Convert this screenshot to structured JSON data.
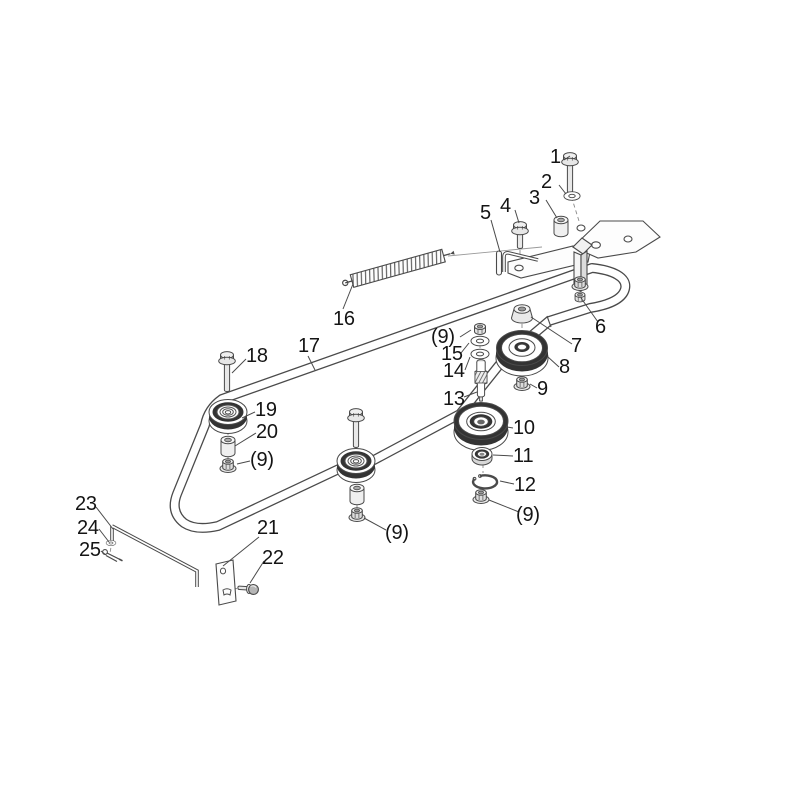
{
  "diagram": {
    "kind": "exploded-parts-diagram",
    "colors": {
      "background": "#ffffff",
      "line": "#4a4a4a",
      "dark_fill": "#333333",
      "label_text": "#141414"
    },
    "callouts": [
      {
        "id": "c1",
        "label": "1"
      },
      {
        "id": "c2",
        "label": "2"
      },
      {
        "id": "c3",
        "label": "3"
      },
      {
        "id": "c4",
        "label": "4"
      },
      {
        "id": "c5",
        "label": "5"
      },
      {
        "id": "c6",
        "label": "6"
      },
      {
        "id": "c7",
        "label": "7"
      },
      {
        "id": "c8",
        "label": "8"
      },
      {
        "id": "c9",
        "label": "9"
      },
      {
        "id": "c10",
        "label": "10"
      },
      {
        "id": "c11",
        "label": "11"
      },
      {
        "id": "c12",
        "label": "12"
      },
      {
        "id": "c13",
        "label": "13"
      },
      {
        "id": "c14",
        "label": "14"
      },
      {
        "id": "c15",
        "label": "15"
      },
      {
        "id": "c16",
        "label": "16"
      },
      {
        "id": "c17",
        "label": "17"
      },
      {
        "id": "c18",
        "label": "18"
      },
      {
        "id": "c19",
        "label": "19"
      },
      {
        "id": "c20",
        "label": "20"
      },
      {
        "id": "c21",
        "label": "21"
      },
      {
        "id": "c22",
        "label": "22"
      },
      {
        "id": "c23",
        "label": "23"
      },
      {
        "id": "c24",
        "label": "24"
      },
      {
        "id": "c25",
        "label": "25"
      },
      {
        "id": "c9qty-right-top",
        "label": "(9)"
      },
      {
        "id": "c9qty-right-bottom",
        "label": "(9)"
      },
      {
        "id": "c9qty-left",
        "label": "(9)"
      },
      {
        "id": "c9qty-center",
        "label": "(9)"
      }
    ]
  }
}
